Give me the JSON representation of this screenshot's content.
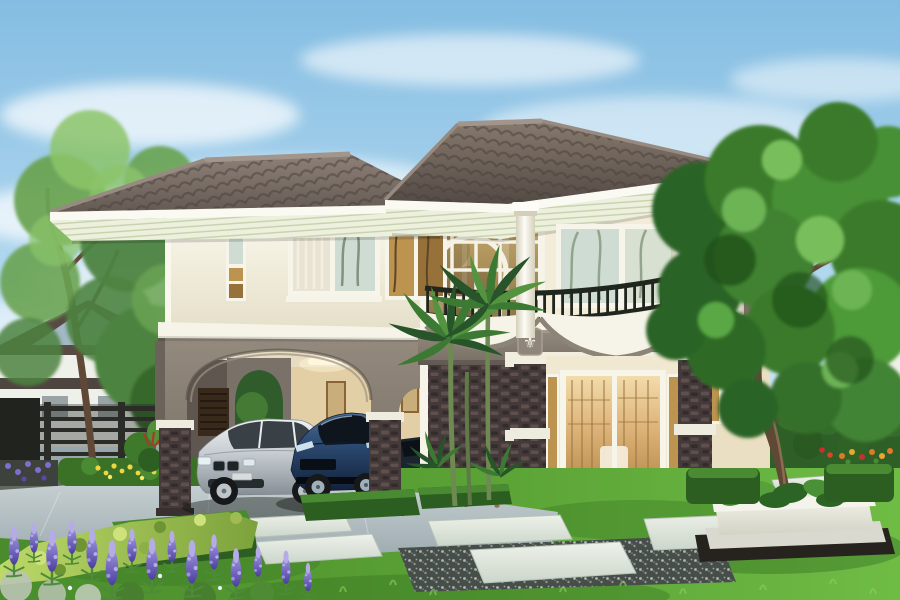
{
  "scene": {
    "alt": "Photorealistic architectural rendering of a two-story cream house with a dark hip tile roof, arched carport sheltering a silver sedan and a dark blue sports car, a curved second-floor balcony with dark railing, a round feature window, dark stone-clad pillars, a glass entrance door glowing warm, palm trees, a large leafy tree on the right, manicured lawn with stepping stones, trimmed hedges and purple lupine flowers in the foreground",
    "objects": [
      "sky",
      "clouds",
      "neighbor-house-left",
      "neighbor-house-right",
      "metal-fence",
      "deciduous-tree-left",
      "distant-trees",
      "two-story-house",
      "hip-tile-roof",
      "slatted-soffit",
      "carport",
      "carport-arch",
      "louvered-door",
      "wall-art-panels",
      "ceiling-light",
      "silver-sedan",
      "blue-sports-car",
      "dark-car",
      "circular-feature-window",
      "glass-curtain-wall",
      "bedroom-windows",
      "corner-amber-window",
      "balcony",
      "balcony-railing",
      "white-columns",
      "tulip-emblems",
      "stone-clad-pillars",
      "entrance-glass-door",
      "sidelights",
      "porch-step",
      "palm-trees",
      "large-tree-right",
      "tree-planter",
      "front-lawn",
      "driveway",
      "stepping-stones",
      "gravel-strips",
      "box-hedges",
      "bright-hedge",
      "purple-lupines",
      "yellow-flowers",
      "orange-flowers",
      "hedge-wall"
    ]
  },
  "palette": {
    "sky-top": "#84bde2",
    "sky-mid": "#b6daf0",
    "sky-low": "#e6f2f8",
    "cloud": "#ffffff",
    "roof-hi": "#8e8178",
    "roof-lo": "#5f554e",
    "roof-hi2": "#877a6e",
    "roof-lo2": "#544a44",
    "roof-line": "#48403b",
    "ridge": "#a2958c",
    "fascia": "#fbfaf2",
    "soffit": "#edf0dd",
    "soffit-line": "#c7d1ae",
    "wall-hi": "#faf8ec",
    "wall-lo": "#e5dfc8",
    "cornice": "#f6f4e8",
    "band-hi": "#948a7e",
    "band-lo": "#776e64",
    "band-side": "#6b6259",
    "stone-bg": "#453a3a",
    "stone-hi": "#5f4f4d",
    "stone-lo": "#342b2c",
    "stone-cap": "#edecdf",
    "plinth": "#39302f",
    "frame": "#f7f5ea",
    "glass-cool": "#cfdcd4",
    "glass-curtain": "#e8e3d2",
    "glass-amber": "#bd9350",
    "glass-amber-lo": "#96713a",
    "glass-dark": "#474438",
    "glasswall-hi": "#c7a96a",
    "glasswall-lo": "#79663e",
    "mullion": "#f5f2e5",
    "rail": "#20261e",
    "col-edge": "#d3cfba",
    "col-mid": "#fdfcf6",
    "lintel": "#f1eee0",
    "door-hi": "#f2dcab",
    "door-mid": "#dfb67c",
    "door-lo": "#b98c4c",
    "interior-wood": "#9a7340",
    "interior-white": "#f4ecd9",
    "int-ceiling": "#e8dcc0",
    "int-wall": "#e3cfa6",
    "int-wall-dark": "#5f574f",
    "int-floor": "#a39a86",
    "louver": "#39291b",
    "art": "#c9ad7a",
    "art-frame": "#8a6436",
    "light-warm": "#fff6dc",
    "lawn-l": "#4a8c2c",
    "lawn-m": "#5ba336",
    "lawn-r": "#6fbc45",
    "lawn-shadow": "#2f6a1e",
    "hedge-dark": "#2b5e20",
    "hedge-mid": "#3a7127",
    "hedge-top": "#4a8a33",
    "hedge-lite": "#6aa84a",
    "bright-hi": "#bcd968",
    "bright-lo": "#7ca23c",
    "bright-dot": "#cde27a",
    "drive-hi": "#c8d1d3",
    "drive-lo": "#9dabb0",
    "curb": "#62685f",
    "darkwall": "#3d423c",
    "paver-hi": "#eef2ea",
    "paver-lo": "#ccd6cb",
    "paver-edge": "#b7c2b8",
    "gravel": "#474e4a",
    "planter-hi": "#f1f1e8",
    "planter-lo": "#d2d2c5",
    "fence": "#2b2b27",
    "fence-dark": "#1f241f",
    "trunk": "#5f4836",
    "trunk-hi": "#8a6d50",
    "palm-trunk": "#6e8a52",
    "g1": "#2c6425",
    "g2": "#3a7a2c",
    "g3": "#479034",
    "g4": "#6db454",
    "g5": "#78bf5c",
    "gdark": "#1e4c19",
    "ltree-1": "#6aa352",
    "ltree-2": "#4e8340",
    "ltree-3": "#8cc46a",
    "palm-d": "#28542a",
    "palm-m": "#3c7a33",
    "palm-l": "#549441",
    "lupine-hi": "#9c92dc",
    "lupine-lo": "#4b3f9e",
    "lupine-pale": "#b4abe8",
    "leaf": "#4e8a38",
    "silver-foliage": "#b9c4b2",
    "fl-yellow": "#ecd73e",
    "fl-orange": "#e07828",
    "fl-red": "#c83030",
    "fl-purple": "#7d6fd0",
    "silver-hi": "#f0f3f5",
    "silver-mid": "#c6ccd1",
    "silver-lo": "#878f96",
    "car-glass": "#394046",
    "car-line": "#9aa2a8",
    "blue-hi": "#4a6c94",
    "blue-mid": "#2c4a72",
    "blue-lo": "#12213a",
    "blue-glass": "#0e151d",
    "tire": "#17181a",
    "rim": "#bdc5cb",
    "nb-roof": "#564a42",
    "nb-gable": "#a2b8c4",
    "nb-wall": "#eef0ea",
    "nb-roof2": "#6e5244",
    "nb-band": "#4e4540"
  }
}
